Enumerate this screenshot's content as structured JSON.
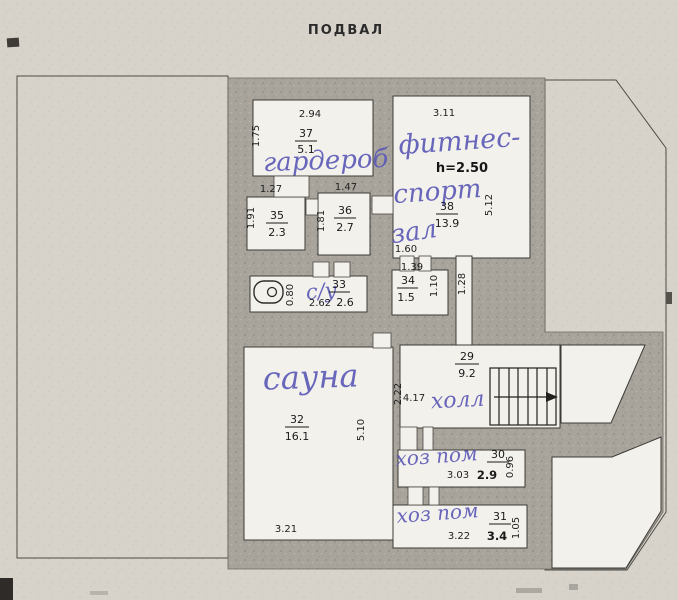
{
  "title": "ПОДВАЛ",
  "colors": {
    "paper": "#d7d3ca",
    "wall_fill": "#a8a49c",
    "room_fill": "#f3f1ec",
    "ink": "#1a1a1a",
    "handwriting": "#5d5bb6"
  },
  "rooms": {
    "r37": {
      "num": "37",
      "area": "5.1",
      "dim_top": "2.94",
      "dim_left": "1.75",
      "label": "гардероб"
    },
    "r38": {
      "num": "38",
      "area": "13.9",
      "dim_top": "3.11",
      "dim_right": "5.12",
      "dim_bottom": "1.60",
      "ceiling": "h=2.50",
      "label1": "фитнес-",
      "label2": "спорт",
      "label3": "зал"
    },
    "r35": {
      "num": "35",
      "area": "2.3",
      "dim_top": "1.27",
      "dim_left": "1.91"
    },
    "r36": {
      "num": "36",
      "area": "2.7",
      "dim_top": "1.47",
      "dim_left": "1.81"
    },
    "r33": {
      "num": "33",
      "area": "2.6",
      "dim_left": "0.80",
      "dim_bottom": "2.62",
      "label": "с/у"
    },
    "r34": {
      "num": "34",
      "area": "1.5",
      "dim_top": "1.39",
      "dim_right": "1.10",
      "dim_corridor": "1.28"
    },
    "r32": {
      "num": "32",
      "area": "16.1",
      "dim_right": "5.10",
      "dim_bottom": "3.21",
      "label": "сауна"
    },
    "r29": {
      "num": "29",
      "area": "9.2",
      "dim_left": "2.22",
      "dim_width": "4.17",
      "label": "холл"
    },
    "r30": {
      "num": "30",
      "area": "2.9",
      "dim_bottom": "3.03",
      "dim_right": "0.96",
      "label": "хоз пом"
    },
    "r31": {
      "num": "31",
      "area": "3.4",
      "dim_bottom": "3.22",
      "dim_right": "1.05",
      "label": "хоз пом"
    }
  }
}
